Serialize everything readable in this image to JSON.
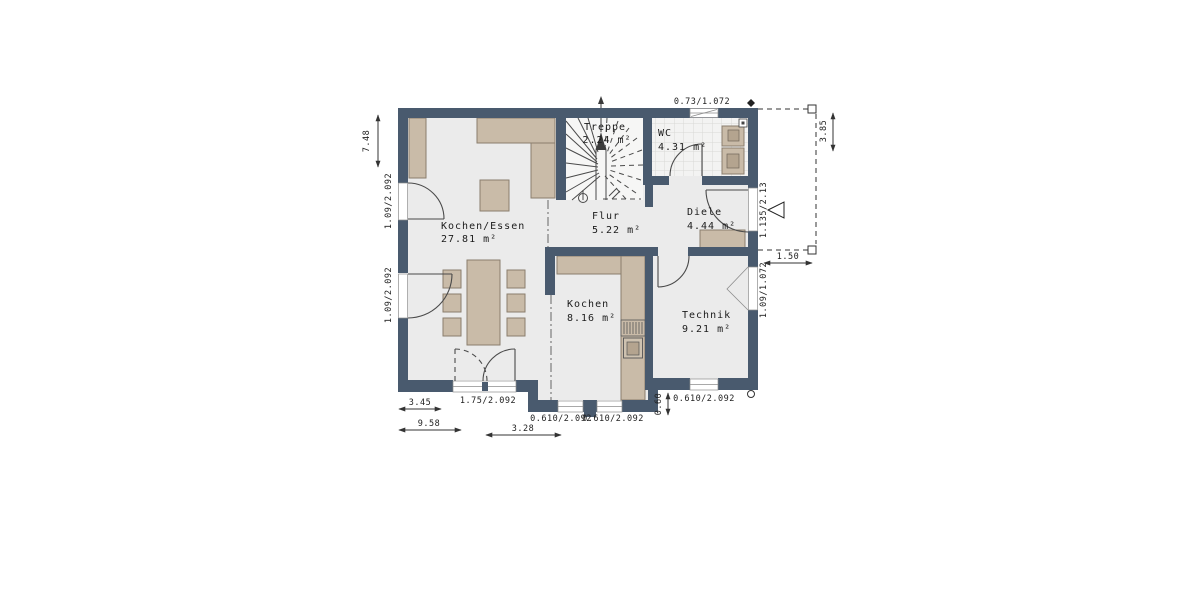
{
  "plan": {
    "rooms": [
      {
        "name": "Kochen/Essen",
        "area": "27.81 m²"
      },
      {
        "name": "Flur",
        "area": "5.22 m²"
      },
      {
        "name": "Treppe",
        "area": "2.24 m²"
      },
      {
        "name": "WC",
        "area": "4.31 m²"
      },
      {
        "name": "Diele",
        "area": "4.44 m²"
      },
      {
        "name": "Kochen",
        "area": "8.16 m²"
      },
      {
        "name": "Technik",
        "area": "9.21 m²"
      }
    ],
    "dimensions": {
      "building_height_left": "7.48",
      "door_window_left_upper": "1.09/2.092",
      "door_window_left_lower": "1.09/2.092",
      "wc_window_top": "0.73/1.072",
      "entry_door_right": "1.135/2.13",
      "porch_width": "1.50",
      "porch_depth_right": "3.85",
      "technik_window_right": "1.09/1.072",
      "patio_door_bottom": "1.75/2.092",
      "bottom_partial_width": "3.45",
      "bottom_total_width": "9.58",
      "kochen_window_1": "0.610/2.092",
      "kochen_window_2": "0.610/2.092",
      "kochen_bay_width": "3.28",
      "technik_window_bottom": "0.610/2.092",
      "bay_step_depth": "0.60"
    },
    "colors": {
      "wall": "#495a6e",
      "floor": "#ebebeb",
      "furniture": "#c9bba8"
    }
  }
}
